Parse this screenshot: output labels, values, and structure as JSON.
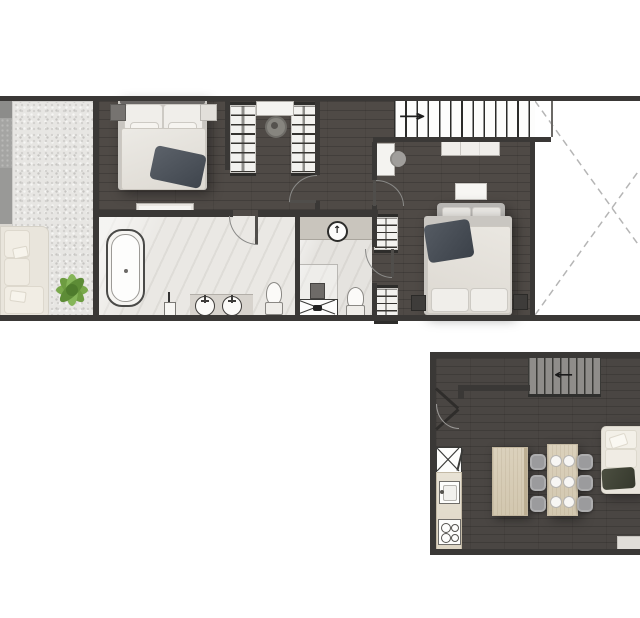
{
  "canvas": {
    "background": "#ffffff",
    "plans_count": 2,
    "visible_text": "none"
  },
  "palette": {
    "page_bg": "#ffffff",
    "wall": "#3a3836",
    "floor_dark": "#4f4a46",
    "floor_dark2": "#4a4643",
    "bath_floor": "#eae8e4",
    "shower_strip": "#c9c5bd",
    "gravel": "#e7e6e3",
    "dash": "#b5b5b5",
    "white_furn": "#f4f3f0",
    "cream": "#e9e5dc",
    "wood_light": "#dbd1bc",
    "gray_chair": "#9b9b9d",
    "gray_settee": "#b7b5b2",
    "duvet": "#e3e0da",
    "platform": "#c9c6c1",
    "throw_dark": "#4f555d",
    "olive_throw": "#42453a",
    "plant_green": "#7aa94c",
    "plant_green_dark": "#5d8c36",
    "stair_fill_lower": "#8f8d8a",
    "arc": "#8a8a88"
  },
  "icons": {
    "stair_direction_upper": "→",
    "stair_direction_lower": "←",
    "shower_symbol": "↑"
  },
  "upper_floor": {
    "name": "upper floor plan",
    "areas": [
      {
        "name": "living-corner",
        "furniture": [
          "corner-sofa",
          "potted-plant"
        ]
      },
      {
        "name": "gravel-lightwell-strip"
      },
      {
        "name": "bedroom-1",
        "furniture": [
          "double-bed",
          "nightstand-left",
          "nightstand-right",
          "foot-bench"
        ]
      },
      {
        "name": "walk-in-closet",
        "furniture": [
          "wardrobe-left",
          "wardrobe-right",
          "dressing-table",
          "stool"
        ]
      },
      {
        "name": "bathroom",
        "furniture": [
          "freestanding-bathtub",
          "vanity-with-2-round-sinks",
          "toilet",
          "towel-stand"
        ]
      },
      {
        "name": "shower-room",
        "furniture": [
          "shower-strip",
          "shower-symbol-circle",
          "shower-enclosure",
          "floor-drain",
          "shower-tray-x",
          "toilet"
        ]
      },
      {
        "name": "hallway",
        "doors": 4
      },
      {
        "name": "bedroom-2",
        "furniture": [
          "double-bed",
          "settee",
          "nightstand-left",
          "nightstand-right",
          "desk",
          "desk-chair",
          "dresser",
          "built-in-wardrobe-top",
          "built-in-wardrobe-bottom",
          "media-unit"
        ]
      },
      {
        "name": "staircase",
        "direction": "right"
      },
      {
        "name": "void",
        "marking": "dashed-x"
      }
    ]
  },
  "lower_floor": {
    "name": "lower floor plan",
    "areas": [
      {
        "name": "entry",
        "furniture": [
          "double-pivot-door"
        ]
      },
      {
        "name": "staircase",
        "direction": "left"
      },
      {
        "name": "kitchen",
        "furniture": [
          "tall-unit-x",
          "counter",
          "sink",
          "cooktop-4-burners",
          "island"
        ]
      },
      {
        "name": "dining",
        "furniture": [
          "table",
          "chairs-x6",
          "place-settings-x6"
        ]
      },
      {
        "name": "living",
        "furniture": [
          "chaise-sofa",
          "throw-blanket",
          "console"
        ]
      }
    ]
  }
}
